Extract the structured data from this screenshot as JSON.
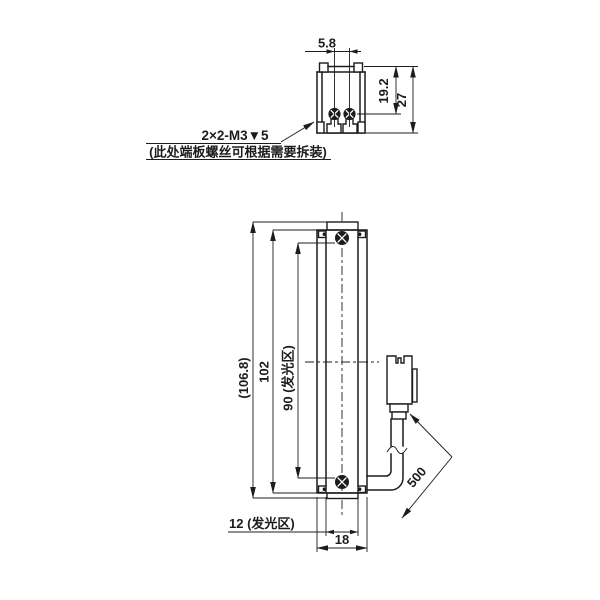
{
  "drawing": {
    "note": {
      "line1": "2×2-M3▼5",
      "line2": "(此处端板螺丝可根据需要拆装)"
    },
    "top_view": {
      "dim_screw_spacing": "5.8",
      "dim_top_to_screw": "19.2",
      "dim_height": "27"
    },
    "front_view": {
      "dim_overall_length": "(106.8)",
      "dim_body_length": "102",
      "dim_luminous_length": "90 (发光区)",
      "dim_luminous_width": "12 (发光区)",
      "dim_width": "18",
      "dim_cable_length": "500"
    },
    "colors": {
      "line": "#1c1c1c",
      "background": "#ffffff"
    }
  }
}
